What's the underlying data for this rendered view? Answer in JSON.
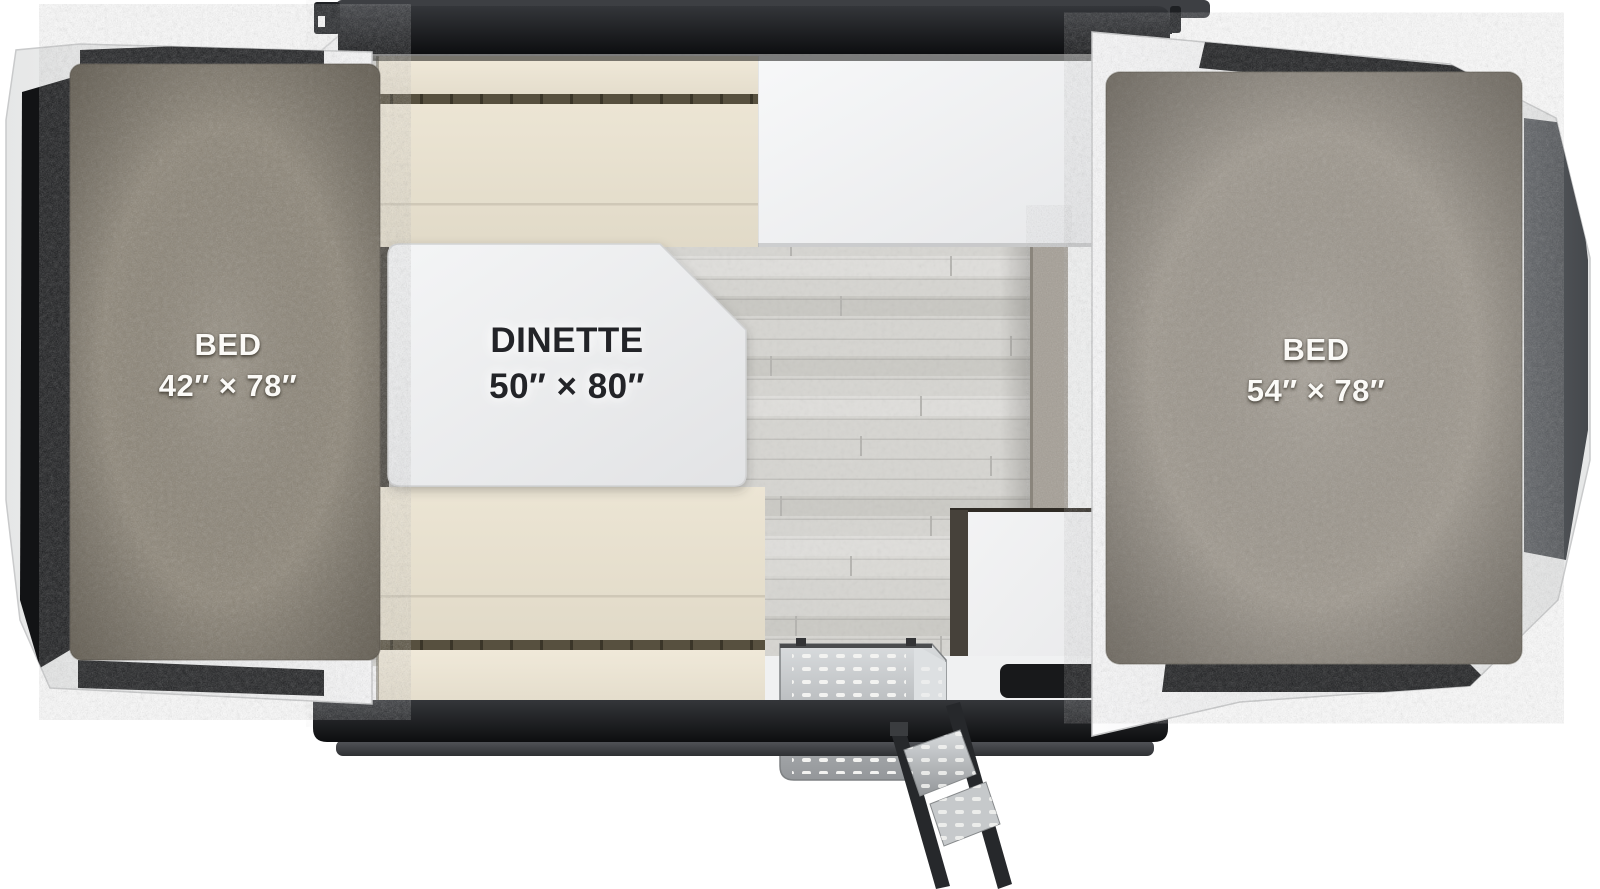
{
  "areas": {
    "left_bed": {
      "name": "BED",
      "dimensions": "42″ × 78″"
    },
    "dinette": {
      "name": "DINETTE",
      "dimensions": "50″ × 80″"
    },
    "right_bed": {
      "name": "BED",
      "dimensions": "54″ × 78″"
    }
  },
  "features": [
    "tent bed platform with black windows (left)",
    "tent bed platform with black windows (right)",
    "dinette bench seats",
    "dinette table",
    "kitchen counter",
    "cabinet",
    "wood plank floor",
    "entry step with fold-out ladder",
    "entry floor mat",
    "roof trim rails"
  ],
  "colors": {
    "mattress_left": "#8a8273",
    "mattress_right": "#9c958a",
    "cushion_beige": "#e7e0cf",
    "seam_dark": "#57503f",
    "canvas_white": "#f6f7f7",
    "roof_trim_black": "#1b1d1f",
    "window_black": "#161719",
    "end_window_gray": "#53565a",
    "table_white": "#eceded",
    "floor_wood": "#d6d5d1",
    "step_metal": "#c2c5c7",
    "cabinet_edge": "#46413a"
  }
}
